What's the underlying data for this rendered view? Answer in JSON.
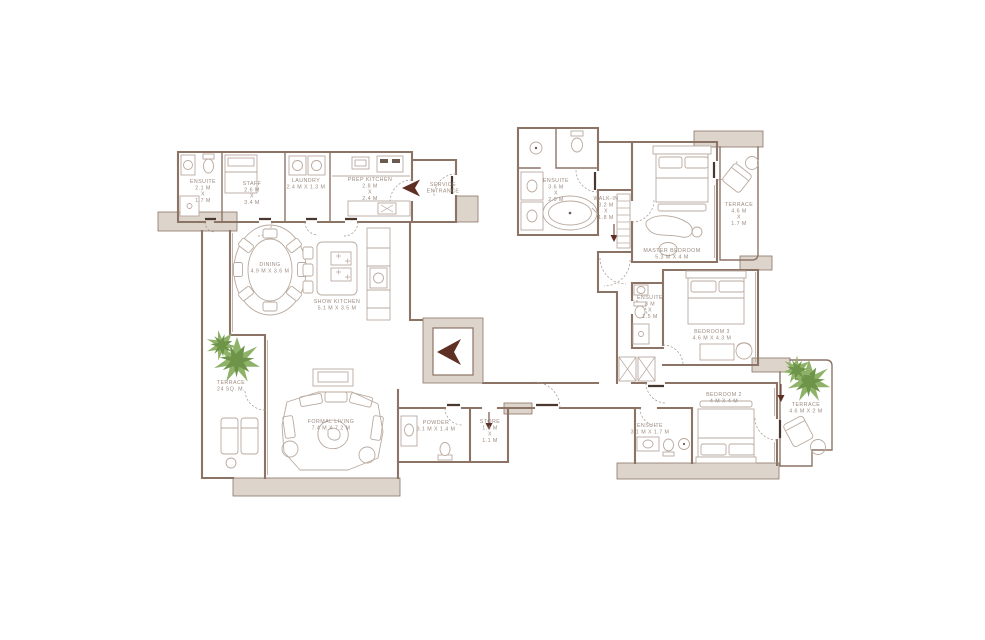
{
  "plan": {
    "colors": {
      "wall": "#8b7466",
      "slab_fill": "#ddd4cc",
      "furniture": "#b9aa9f",
      "label_text": "#9c8b81",
      "plant_green": "#8fb269",
      "plant_green_dark": "#6d9449",
      "arrow_maroon": "#5f2f23"
    },
    "service_entrance": {
      "line1": "SERVICE",
      "line2": "ENTRANCE"
    },
    "rooms": {
      "staff_ensuite": {
        "name": "ENSUITE",
        "lines": [
          "2.1 M",
          "X",
          "1.7 M"
        ]
      },
      "staff": {
        "name": "STAFF",
        "lines": [
          "2.6 M",
          "X",
          "3.4 M"
        ]
      },
      "laundry": {
        "name": "LAUNDRY",
        "lines": [
          "2.4 M X 1.3 M"
        ]
      },
      "prep_kitchen": {
        "name": "PREP KITCHEN",
        "lines": [
          "2.8 M",
          "X",
          "2.4 M"
        ]
      },
      "dining": {
        "name": "DINING",
        "lines": [
          "4.9 M X 3.6 M"
        ]
      },
      "show_kitchen": {
        "name": "SHOW KITCHEN",
        "lines": [
          "5.1 M X 3.5 M"
        ]
      },
      "terrace_left": {
        "name": "TERRACE",
        "lines": [
          "24 SQ. M."
        ]
      },
      "formal_living": {
        "name": "FORMAL LIVING",
        "lines": [
          "7.4 M X 7.2 M"
        ]
      },
      "powder": {
        "name": "POWDER",
        "lines": [
          "3.1 M X 1.4 M"
        ]
      },
      "store": {
        "name": "STORE",
        "lines": [
          "1.4 M",
          "X",
          "1.1 M"
        ]
      },
      "master_ensuite": {
        "name": "ENSUITE",
        "lines": [
          "3.6 M",
          "X",
          "2.0 M"
        ]
      },
      "walk_in": {
        "name": "WALK-IN",
        "lines": [
          "3.2 M",
          "X",
          "1.8 M"
        ]
      },
      "master_bedroom": {
        "name": "MASTER BEDROOM",
        "lines": [
          "5.3 M X 4 M"
        ]
      },
      "terrace_top_right": {
        "name": "TERRACE",
        "lines": [
          "4.6 M",
          "X",
          "1.7 M"
        ]
      },
      "bedroom3_ensuite": {
        "name": "ENSUITE",
        "lines": [
          "3 M",
          "X",
          "1.5 M"
        ]
      },
      "bedroom3": {
        "name": "BEDROOM 3",
        "lines": [
          "4.6 M X 4.3 M"
        ]
      },
      "bedroom2": {
        "name": "BEDROOM 2",
        "lines": [
          "4 M X 4 M"
        ]
      },
      "bedroom2_ensuite": {
        "name": "ENSUITE",
        "lines": [
          "3.1 M X 1.7 M"
        ]
      },
      "terrace_right": {
        "name": "TERRACE",
        "lines": [
          "4.6 M X 2 M"
        ]
      }
    }
  }
}
